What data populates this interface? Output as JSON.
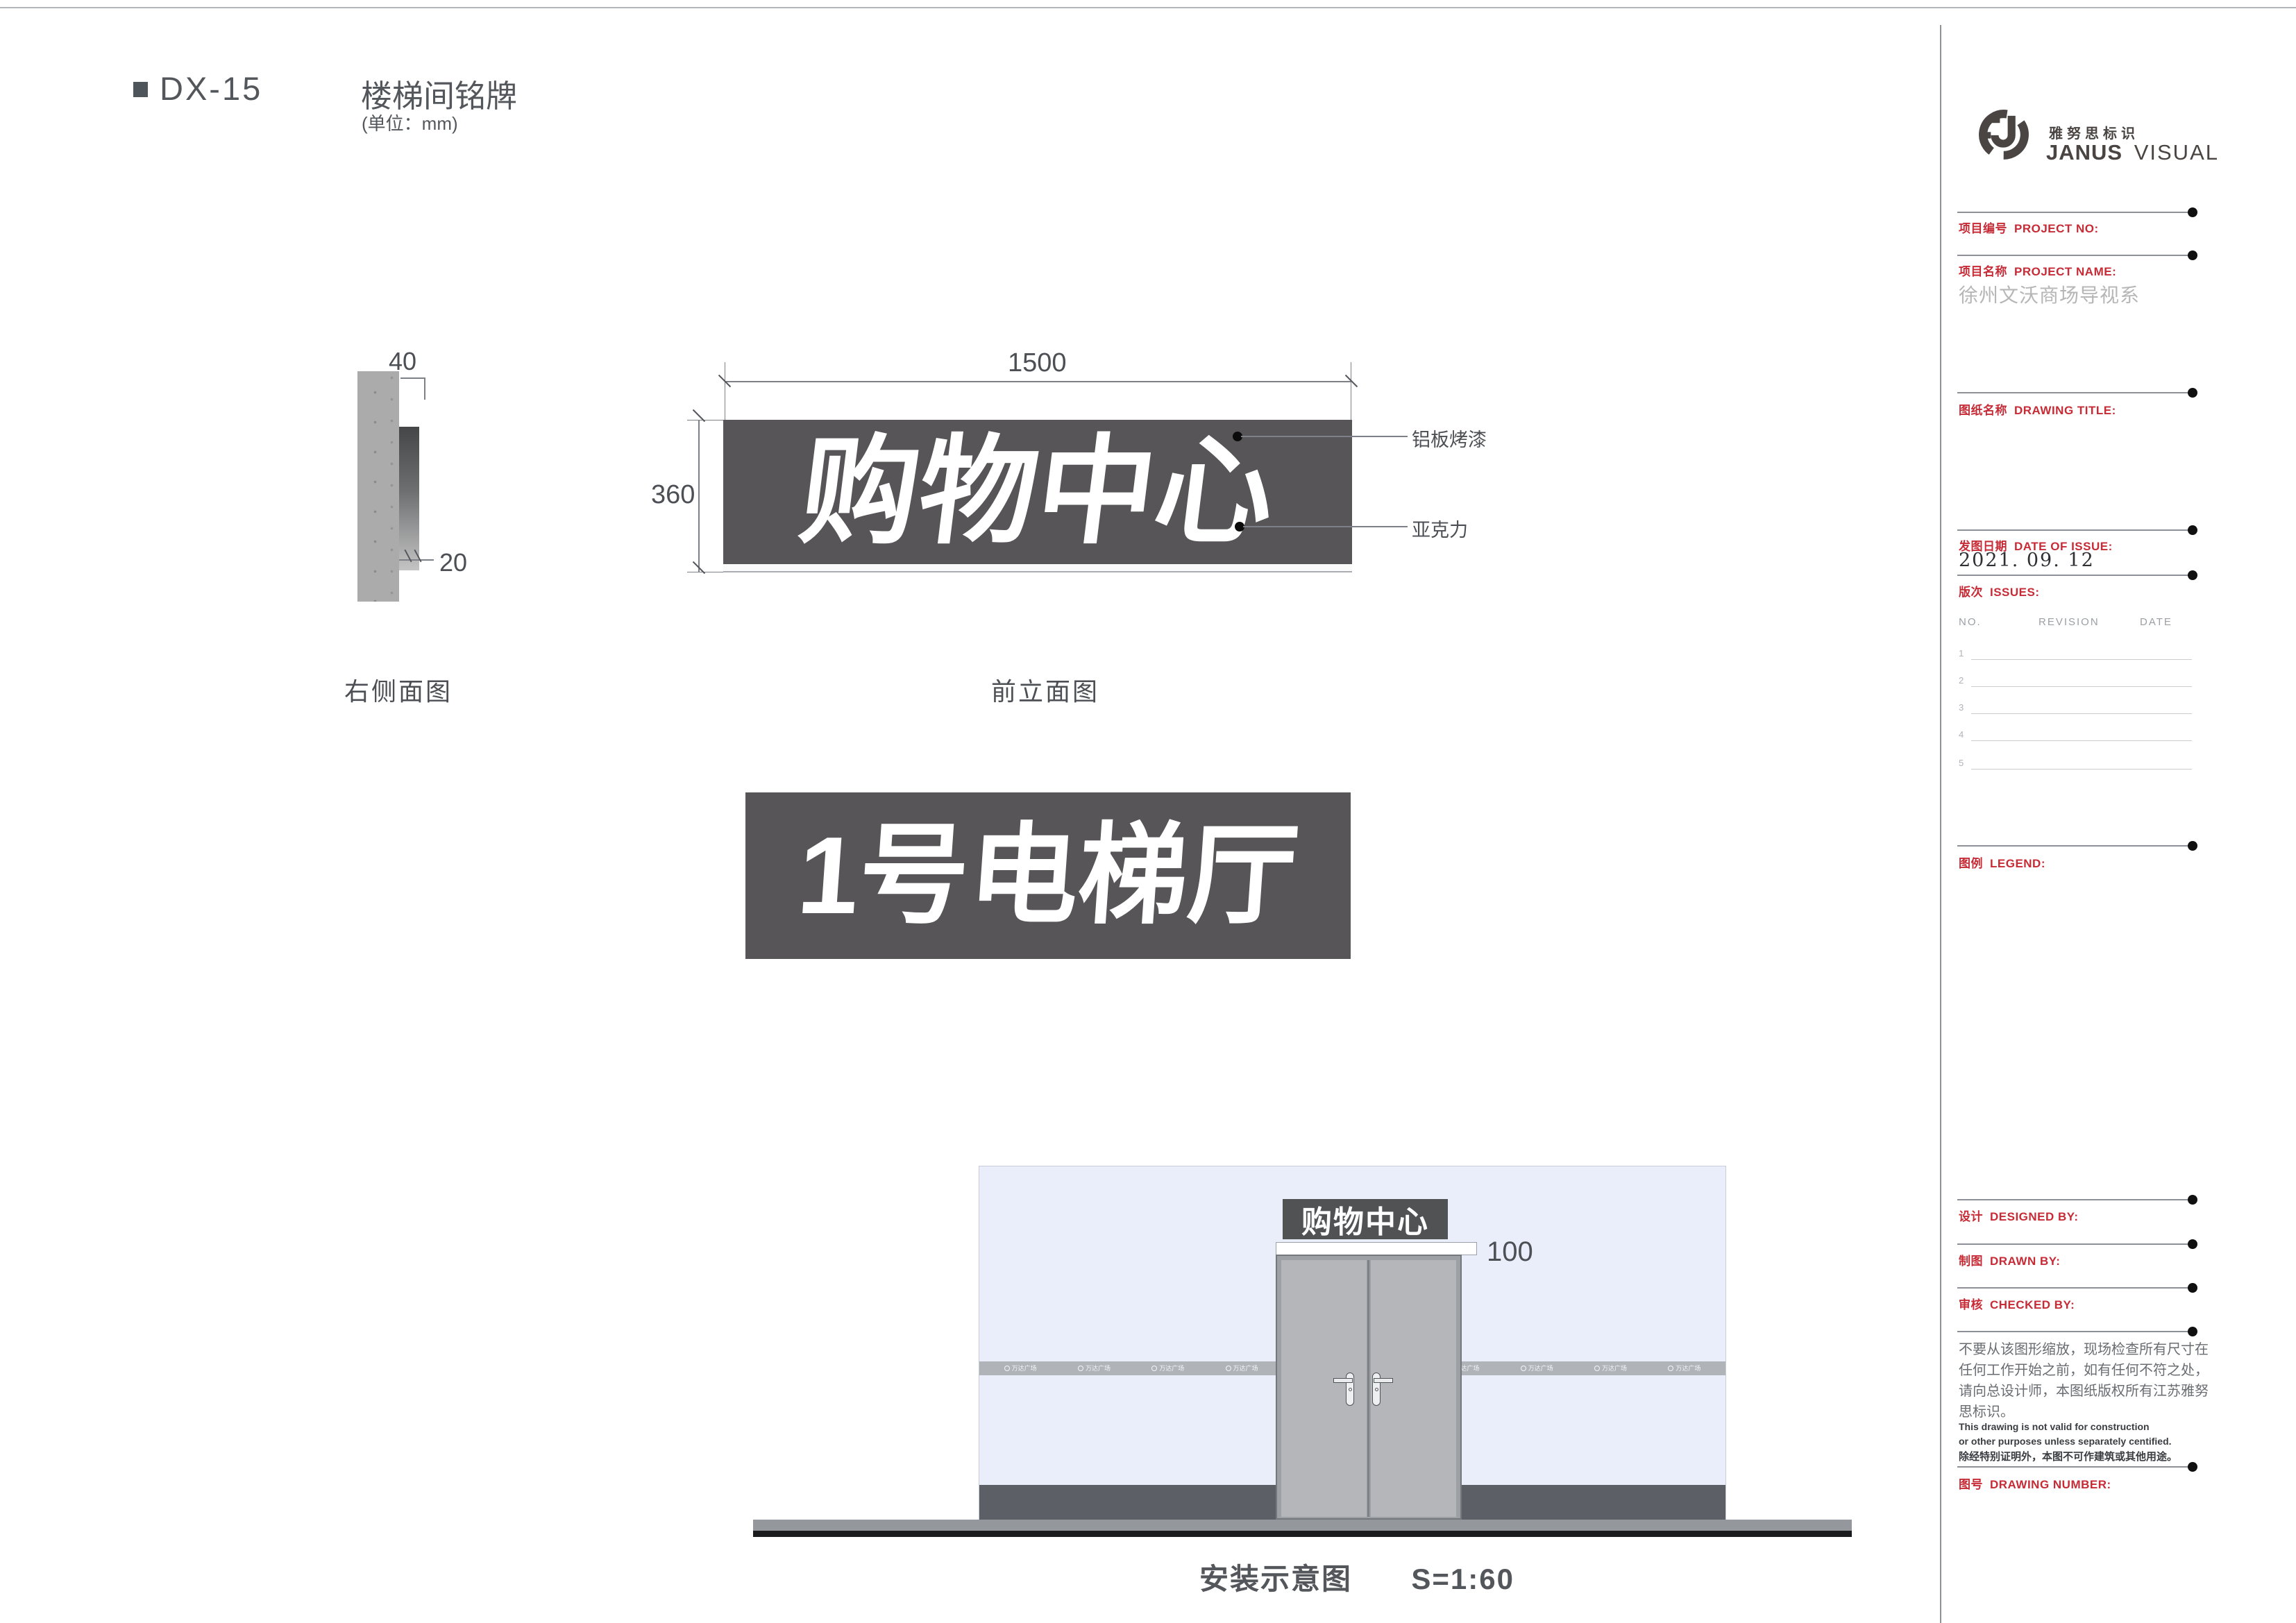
{
  "meta": {
    "accent_red": "#c62b36",
    "panel_dark": "#575557",
    "wall_blue": "#e9eefa"
  },
  "header": {
    "code": "DX-15",
    "title": "楼梯间铭牌",
    "unit": "(单位：mm)"
  },
  "side_view": {
    "label": "右侧面图",
    "dim_width": "40",
    "dim_thickness": "20"
  },
  "front_view": {
    "label": "前立面图",
    "dim_width": "1500",
    "dim_height": "360",
    "sign_text": "购物中心",
    "callout_top": "铝板烤漆",
    "callout_bottom": "亚克力"
  },
  "panel2": {
    "sign_text": "1号电梯厅"
  },
  "install": {
    "caption": "安装示意图",
    "scale": "S=1:60",
    "sign_text": "购物中心",
    "dim": "100",
    "band_logo": "万达广场"
  },
  "sidebar": {
    "brand_cn": "雅努思标识",
    "brand_en_bold": "JANUS",
    "brand_en_light": "VISUAL",
    "project_no": {
      "cn": "项目编号",
      "en": "PROJECT NO:"
    },
    "project_name": {
      "cn": "项目名称",
      "en": "PROJECT NAME:",
      "value": "徐州文沃商场导视系"
    },
    "drawing_title": {
      "cn": "图纸名称",
      "en": "DRAWING TITLE:"
    },
    "date_of_issue": {
      "cn": "发图日期",
      "en": "DATE OF ISSUE:",
      "value": "2021. 09. 12"
    },
    "issues": {
      "cn": "版次",
      "en": "ISSUES:",
      "headers": [
        "NO.",
        "REVISION",
        "DATE"
      ],
      "rows": [
        "1",
        "2",
        "3",
        "4",
        "5"
      ]
    },
    "legend": {
      "cn": "图例",
      "en": "LEGEND:"
    },
    "designed_by": {
      "cn": "设计",
      "en": "DESIGNED BY:"
    },
    "drawn_by": {
      "cn": "制图",
      "en": "DRAWN BY:"
    },
    "checked_by": {
      "cn": "审核",
      "en": "CHECKED BY:"
    },
    "drawing_number": {
      "cn": "图号",
      "en": "DRAWING NUMBER:"
    },
    "disclaimer_cn": "不要从该图形缩放，现场检查所有尺寸在任何工作开始之前，如有任何不符之处，请向总设计师，本图纸版权所有江苏雅努思标识。",
    "disclaimer_en_1": "This drawing is not valid for construction",
    "disclaimer_en_2": "or other purposes unless separately centified.",
    "disclaimer_cn_2": "除经特别证明外，本图不可作建筑或其他用途。"
  }
}
